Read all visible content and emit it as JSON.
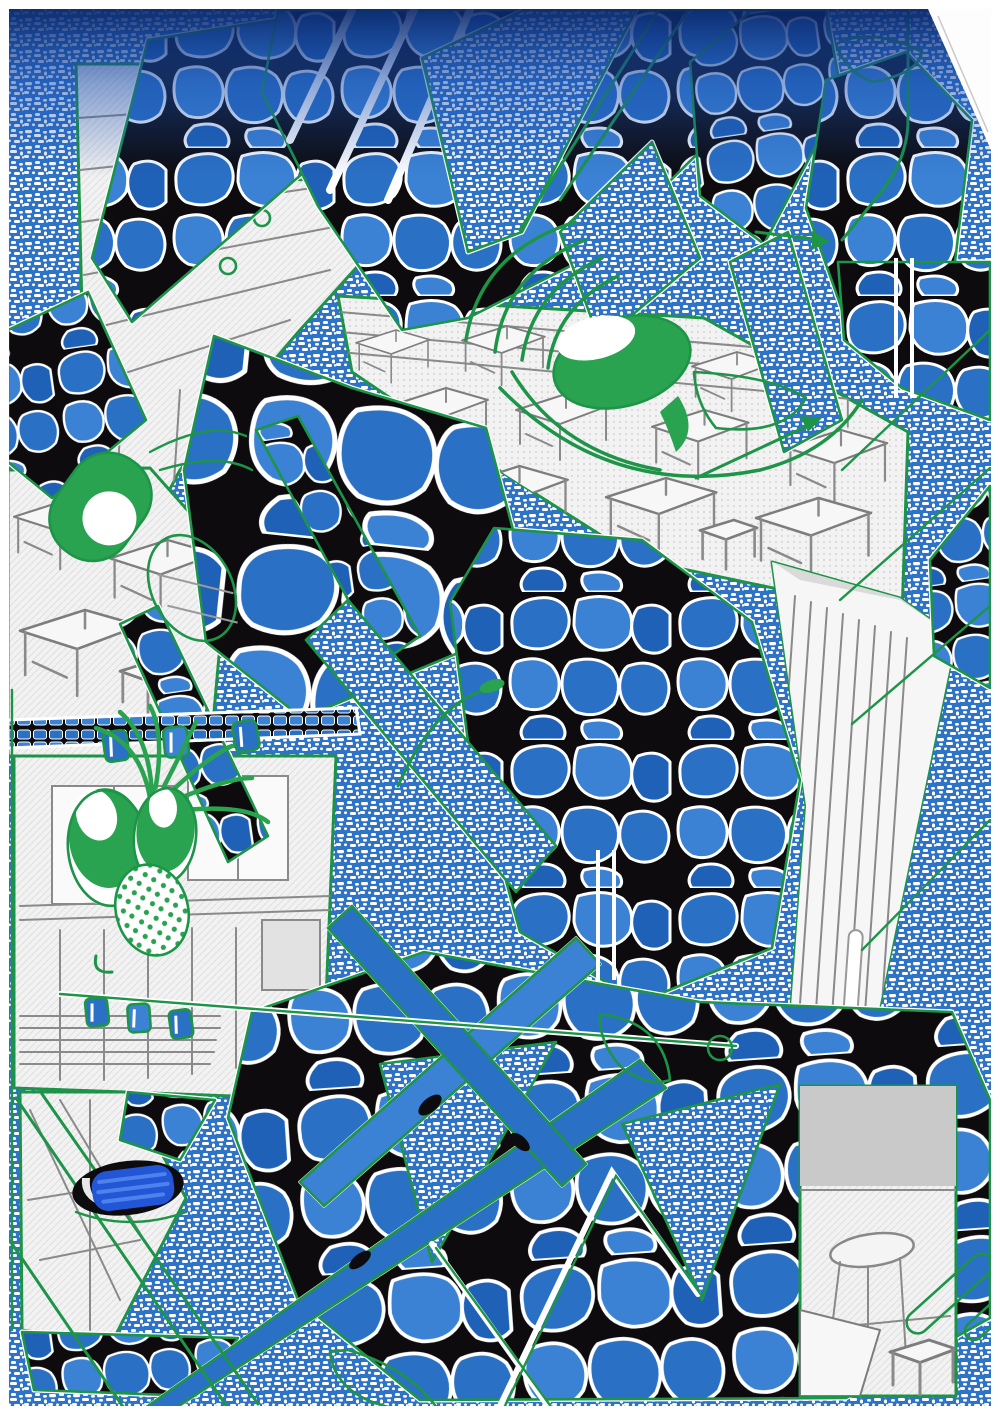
{
  "artwork": {
    "type": "abstract mixed-media collage",
    "scene": "manga classroom with desks and windows overlaid by blue cobblestone shards, woven blue halftone texture, green marker doodles, a cartoon face with green eyes, bead strings, lamp crescents and a blue marker scribble",
    "elements": [
      "halftone-texture-field",
      "cobblestone-shards",
      "classroom-windows",
      "green-cartoon-face",
      "green-eye-blob",
      "green-capsule",
      "lamp-crescents",
      "bead-strings",
      "marker-scribble",
      "green-guide-lines",
      "top-navy-gradient"
    ]
  },
  "palette": {
    "paper": "#ffffff",
    "halftone_blue": "#2f73c8",
    "cobble_blue": "#2a70c4",
    "cobble_blue_light": "#3b82d4",
    "cobble_blue_dark": "#1f61b6",
    "grout_black": "#0d0b0e",
    "marker_green": "#2aa351",
    "line_green": "#1d9448",
    "navy_dark": "#0a2668",
    "navy_mid": "#1b4fae",
    "scribble_blue": "#2256d6",
    "scribble_blue_light": "#4b82ec",
    "sketch_line": "#8a8a8a",
    "wall_grey": "#ececec"
  }
}
